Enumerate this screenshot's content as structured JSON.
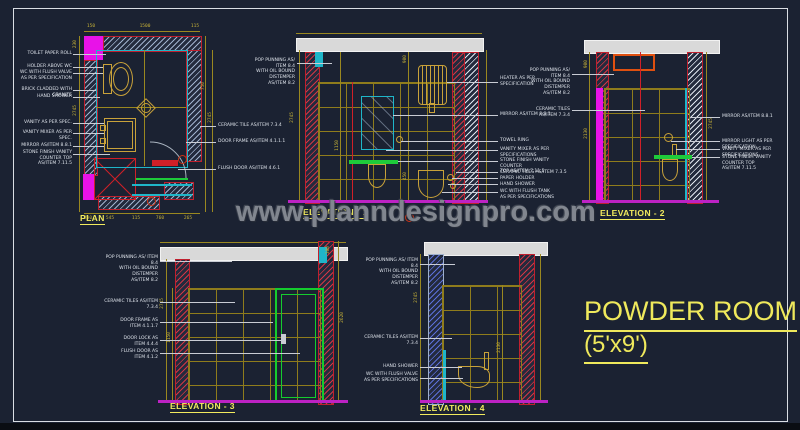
{
  "watermark_text": "www.planndesignpro.com",
  "room": {
    "name": "POWDER ROOM",
    "size": "(5'x9')"
  },
  "colors": {
    "background": "#1b2232",
    "accent_yellow": "#f2eb5e",
    "magenta": "#e812e8",
    "cyan": "#1fb6c9",
    "green": "#1ecb3a",
    "red": "#d02028",
    "gold": "#c9a23a",
    "olive_grid": "#8f7c1c",
    "slab_gray": "#d9d9d9",
    "watermark_gray": "#81868f"
  },
  "views": {
    "plan": {
      "title": "PLAN",
      "labels_left": [
        "TOILET PAPER ROLL",
        "HOLDER ABOVE WC",
        "WC WITH FLUSH VALVE\nAS PER SPECIFICATION",
        "BRICK CLADDED WITH GRANITE",
        "HAND SHOWER",
        "VANITY AS PER SPEC.",
        "VANITY MIXER AS PER SPEC.",
        "MIRROR AS/ITEM 8.8.1",
        "STONE FINISH VANITY COUNTER TOP\nAS/ITEM 7.11.5"
      ],
      "labels_right": [
        "CERAMIC TILE AS/ITEM 7.3.4",
        "DOOR FRAME AS/ITEM 4.1.1.1",
        "FLUSH DOOR AS/ITEM 4.6.1"
      ],
      "dims_top": [
        "150",
        "1500",
        "115"
      ],
      "dims_bottom": [
        "230",
        "545",
        "115",
        "760",
        "265"
      ],
      "dims_left": [
        "230",
        "2745"
      ],
      "dims_right": [
        "750",
        "2745"
      ]
    },
    "elevation1": {
      "title": "ELEVATION - 1",
      "labels_left": [
        "POP PUNNING AS/ ITEM 8.4\nWITH OIL BOUND DISTEMPER\nAS/ITEM 8.2"
      ],
      "labels_right": [
        "HEATER AS PER\nSPECIFICATION",
        "MIRROR AS/ITEM 8.8.1",
        "TOWEL RING",
        "VANITY MIXER AS PER\nSPECIFICATIONS",
        "STONE FINISH VANITY COUNTER\nTOP AS/ITEM 7.11.5",
        "CERAMIC TILES AS/ITEM 7.3.5",
        "PAPER HOLDER",
        "HAND SHOWER",
        "WC WITH FLUSH TANK\nAS PER SPECIFICATIONS"
      ],
      "dims": [
        "2745",
        "900",
        "1150",
        "450"
      ]
    },
    "elevation2": {
      "title": "ELEVATION - 2",
      "labels_left": [
        "POP PUNNING AS/ ITEM 8.4\nWITH OIL BOUND DISTEMPER\nAS/ITEM 8.2",
        "CERAMIC TILES AS/ITEM 7.3.4"
      ],
      "labels_right": [
        "MIRROR AS/ITEM 8.8.1",
        "MIRROR LIGHT AS PER SPECIFICATION",
        "VANITY MIXER AS PER SPECIFICATIONS",
        "STONE FINISH VANITY COUNTER TOP\nAS/ITEM 7.11.5"
      ],
      "dims": [
        "900",
        "2130",
        "2745"
      ]
    },
    "elevation3": {
      "title": "ELEVATION - 3",
      "labels_left": [
        "POP PUNNING AS/ ITEM 8.4\nWITH OIL BOUND DISTEMPER\nAS/ITEM 8.2",
        "CERAMIC TILES AS/ITEM 7.3.4",
        "DOOR FRAME AS\nITEM 4.1.1.7",
        "DOOR LOCK AS\nITEM 4.4.4",
        "FLUSH DOOR AS\nITEM 4.1.2"
      ],
      "dims": [
        "300",
        "2745",
        "1150",
        "2620"
      ]
    },
    "elevation4": {
      "title": "ELEVATION - 4",
      "labels_left": [
        "POP PUNNING AS/ ITEM 8.4\nWITH OIL BOUND DISTEMPER\nAS/ITEM 8.2",
        "CERAMIC TILES AS/ITEM 7.3.4",
        "HAND SHOWER",
        "WC WITH FLUSH VALVE\nAS PER SPECIFICATIONS"
      ],
      "dims": [
        "2745",
        "2130"
      ]
    }
  }
}
